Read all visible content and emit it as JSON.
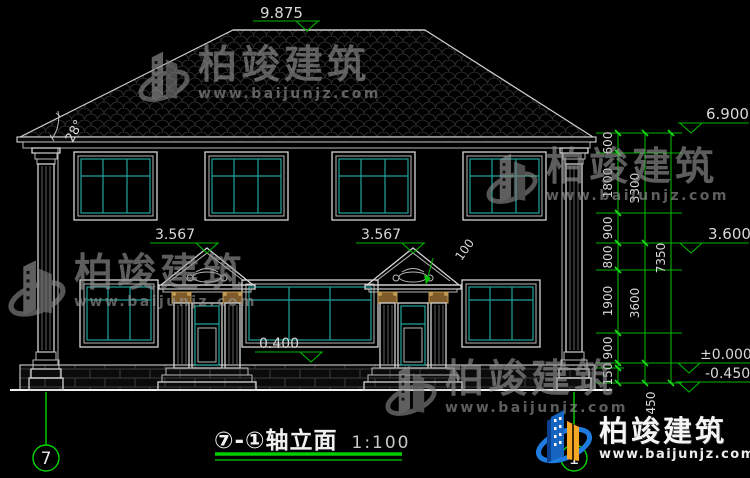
{
  "title_block": {
    "title": "⑦-①轴立面",
    "scale": "1:100"
  },
  "axes": {
    "left": "7",
    "right": "1"
  },
  "elevations": {
    "ridge": "9.875",
    "eave": "6.900",
    "mid": "3.600",
    "zero": "±0.000",
    "ground": "-0.450",
    "porch_left": "3.567",
    "porch_right": "3.567",
    "plinth": "0.400"
  },
  "annotations": {
    "roof_angle": "28°",
    "pediment_edge": "100"
  },
  "dimensions": {
    "col1": [
      "600",
      "1800",
      "900",
      "800",
      "1900",
      "900",
      "150"
    ],
    "col2": [
      "3300",
      "3600",
      "450"
    ],
    "col3": [
      "7350"
    ]
  },
  "watermark": {
    "name": "柏竣建筑",
    "url": "www.baijunjz.com"
  },
  "brand": {
    "name": "柏竣建筑",
    "url": "www.baijunjz.com"
  }
}
